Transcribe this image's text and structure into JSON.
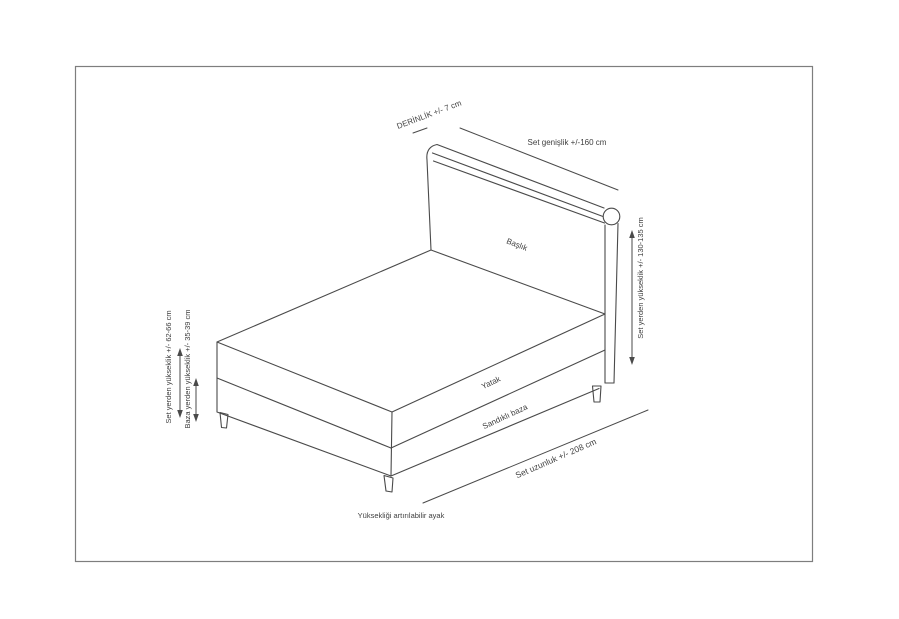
{
  "page": {
    "background": "#ffffff",
    "frame_border_color": "#7e7e7e",
    "line_color": "#4a4a4a",
    "text_color": "#3f3f3f"
  },
  "diagram": {
    "labels": {
      "depth": "DERİNLİK +/- 7 cm",
      "set_width": "Set genişlik +/-160 cm",
      "headboard": "Başlık",
      "set_height_right": "Set yerden yükseklik +/- 130-135 cm",
      "mattress": "Yatak",
      "storage_base": "Sandıklı baza",
      "set_length": "Set uzunluk +/- 208 cm",
      "set_height_left": "Set yerden yükseklik +/- 62-66 cm",
      "base_height_left": "Baza yerden yükseklik +/- 35-39 cm",
      "adjustable_feet": "Yüksekliği artırılabilir ayak"
    }
  }
}
